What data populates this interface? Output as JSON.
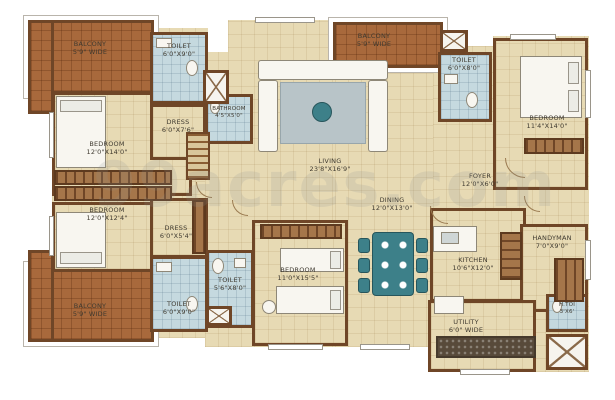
{
  "watermark": "99acres.com",
  "colors": {
    "wall": "#6f4627",
    "floor_beige": "#e7dab4",
    "wet_blue": "#c5d9df",
    "balcony_brick": "#a8693c",
    "accent_teal": "#3d8089",
    "utility_counter": "#584a3a",
    "label_text": "#3f3a30"
  },
  "rooms": [
    {
      "key": "balcony-top-left",
      "name": "BALCONY",
      "dim": "5'9\" WIDE"
    },
    {
      "key": "toilet-top-left",
      "name": "TOILET",
      "dim": "6'0\"X9'0\""
    },
    {
      "key": "dress-top-left",
      "name": "DRESS",
      "dim": "6'0\"X7'6\""
    },
    {
      "key": "bathroom",
      "name": "BATHROOM",
      "dim": "4'5\"X5'0\""
    },
    {
      "key": "bedroom-left-upper",
      "name": "BEDROOM",
      "dim": "12'0\"X14'0\""
    },
    {
      "key": "bedroom-left-lower",
      "name": "BEDROOM",
      "dim": "12'0\"X12'4\""
    },
    {
      "key": "dress-left-lower",
      "name": "DRESS",
      "dim": "6'0\"X5'4\""
    },
    {
      "key": "balcony-bottom-left",
      "name": "BALCONY",
      "dim": "5'9\" WIDE"
    },
    {
      "key": "toilet-bottom-left",
      "name": "TOILET",
      "dim": "6'0\"X9'0\""
    },
    {
      "key": "toilet-middle",
      "name": "TOILET",
      "dim": "5'6\"X8'0\""
    },
    {
      "key": "bedroom-middle",
      "name": "BEDROOM",
      "dim": "11'0\"X15'5\""
    },
    {
      "key": "living",
      "name": "LIVING",
      "dim": "23'8\"X16'9\""
    },
    {
      "key": "dining",
      "name": "DINING",
      "dim": "12'0\"X13'0\""
    },
    {
      "key": "foyer",
      "name": "FOYER",
      "dim": "12'0\"X6'0\""
    },
    {
      "key": "kitchen",
      "name": "KITCHEN",
      "dim": "10'6\"X12'0\""
    },
    {
      "key": "handyman",
      "name": "HANDYMAN",
      "dim": "7'0\"X9'0\""
    },
    {
      "key": "utility",
      "name": "UTILITY",
      "dim": "6'0\" WIDE"
    },
    {
      "key": "handyman-toilet",
      "name": "H.TOI",
      "dim": "3'X6'"
    },
    {
      "key": "balcony-top-right",
      "name": "BALCONY",
      "dim": "5'9\" WIDE"
    },
    {
      "key": "toilet-top-right",
      "name": "TOILET",
      "dim": "6'0\"X8'0\""
    },
    {
      "key": "bedroom-top-right",
      "name": "BEDROOM",
      "dim": "11'4\"X14'0\""
    }
  ]
}
